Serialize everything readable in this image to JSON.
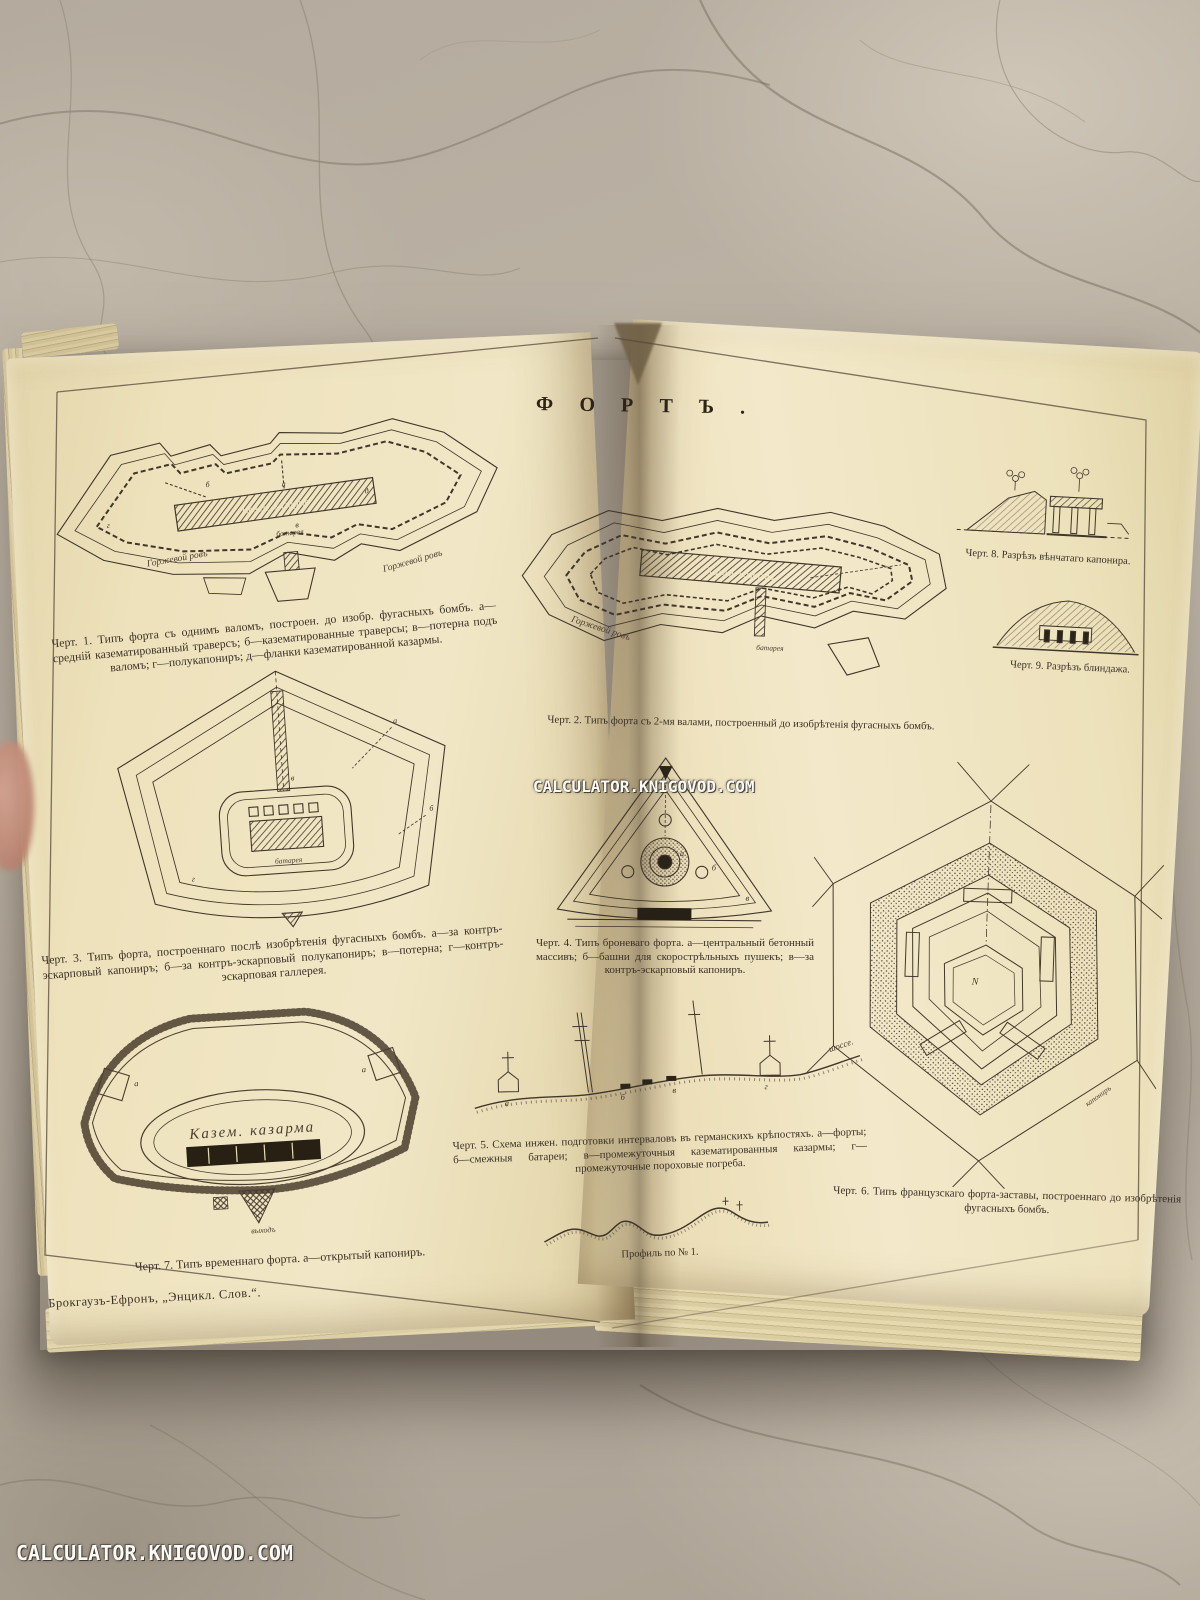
{
  "colors": {
    "page_cream": "#efe4c2",
    "ink": "#3c3328",
    "marble": "#b6ac9f",
    "watermark": "#ffffff"
  },
  "watermarks": {
    "center": "CALCULATOR.KNIGOVOD.COM",
    "bottom_left": "CALCULATOR.KNIGOVOD.COM"
  },
  "book": {
    "title": "ФОРТЪ.",
    "imprint": "Брокгаузъ-Ефронъ, „Энцикл. Слов.“.",
    "profile_caption": "Профиль по № 1.",
    "figures": {
      "fig1": {
        "caption": "Черт. 1. Типъ форта съ однимъ валомъ, построен. до изобр. фугасныхъ бомбъ. а—средній казематированный траверсъ; б—казематированные траверсы; в—потерна подъ валомъ; г—полукапониръ; д—фланки казематированной казармы.",
        "labels": {
          "gorge_ditch_left": "Горжевой ровъ",
          "gorge_ditch_right": "Горжевой ровъ",
          "barracks": "Казем. казарма",
          "battery": "батарея"
        },
        "marks": [
          "а",
          "б",
          "в",
          "г",
          "д"
        ]
      },
      "fig2": {
        "caption": "Черт. 2. Типъ форта съ 2-мя валами, построенный до изобрѣтенія фугасныхъ бомбъ.",
        "labels": {
          "barracks": "Казем. казарма",
          "gorge_ditch": "Горжевой ровъ",
          "battery": "батарея"
        }
      },
      "fig3": {
        "caption": "Черт. 3. Типъ форта, построеннаго послѣ изобрѣтенія фугасныхъ бомбъ. а—за контръ-эскарповый капониръ; б—за контръ-эскарповый полукапониръ; в—потерна; г—контръ-эскарповая галлерея.",
        "labels": {
          "battery": "батарея"
        },
        "marks": [
          "а",
          "б",
          "в",
          "г"
        ]
      },
      "fig4": {
        "caption": "Черт. 4. Типъ броневаго форта. а—центральный бетонный массивъ; б—башни для скорострѣльныхъ пушекъ; в—за контръ-эскарповый капониръ.",
        "marks": [
          "а",
          "б",
          "в"
        ]
      },
      "fig5": {
        "caption": "Черт. 5. Схема инжен. подготовки интерваловъ въ германскихъ крѣпостяхъ. а—форты; б—смежныя батареи; в—промежуточныя казематированныя казармы; г—промежуточные пороховые погреба.",
        "labels": {
          "road": "шоссе."
        },
        "marks": [
          "а",
          "б",
          "в",
          "г"
        ]
      },
      "fig6": {
        "caption": "Черт. 6. Типъ французскаго форта-заставы, построеннаго до изобрѣтенія фугасныхъ бомбъ.",
        "labels": {
          "north": "N",
          "caponier": "капониръ"
        }
      },
      "fig7": {
        "caption": "Черт. 7. Типъ временнаго форта. а—открытый капониръ.",
        "labels": {
          "barracks": "Казем. казарма",
          "exit": "выходъ"
        },
        "marks": [
          "а"
        ]
      },
      "fig8": {
        "caption": "Черт. 8. Разрѣзъ вѣнчатаго капонира."
      },
      "fig9": {
        "caption": "Черт. 9. Разрѣзъ блиндажа."
      }
    }
  }
}
